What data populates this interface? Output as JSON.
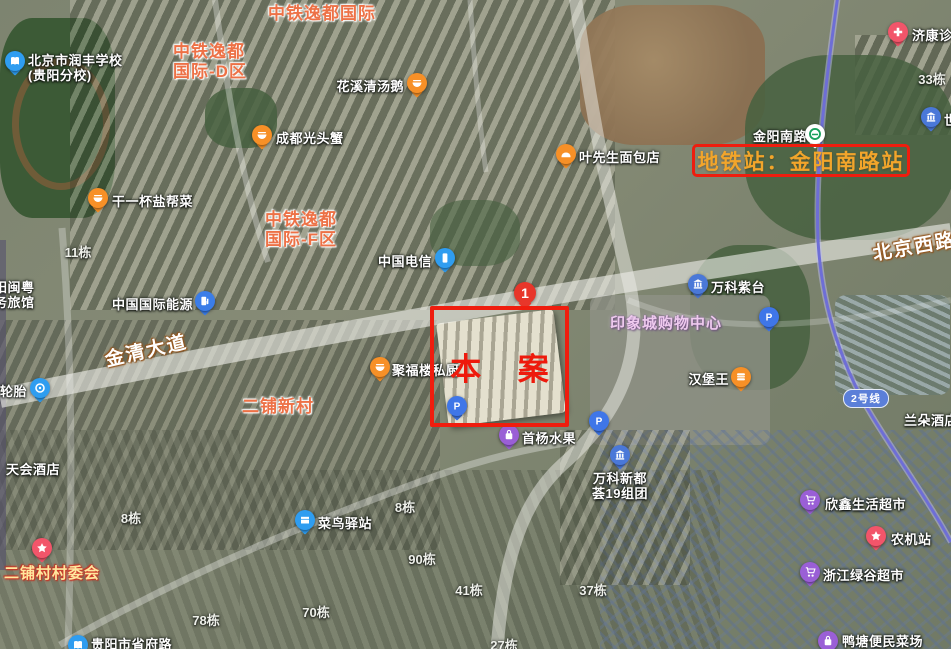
{
  "annotations": {
    "site_label": "本 案",
    "site_marker_number": "1",
    "metro_station_label": "地铁站：金阳南路站"
  },
  "metro": {
    "line_badge": "2号线",
    "badge_x": 843,
    "badge_y": 389
  },
  "road_labels": [
    {
      "name": "jinqing-avenue",
      "label": "金清大道",
      "x": 104,
      "y": 336,
      "rotate": -13
    },
    {
      "name": "beijing-west-road",
      "label": "北京西路",
      "x": 872,
      "y": 232,
      "rotate": -10
    }
  ],
  "area_labels": [
    {
      "name": "zhongtie-yidu-intl",
      "style": "estate",
      "lines": [
        "中铁逸都国际"
      ],
      "x": 268,
      "y": 4
    },
    {
      "name": "zhongtie-yidu-d",
      "style": "estate",
      "lines": [
        "中铁逸都",
        "国际-D区"
      ],
      "x": 173,
      "y": 42
    },
    {
      "name": "zhongtie-yidu-f",
      "style": "estate",
      "lines": [
        "中铁逸都",
        "国际-F区"
      ],
      "x": 265,
      "y": 210
    },
    {
      "name": "erpu-xincun",
      "style": "estate",
      "lines": [
        "二铺新村"
      ],
      "x": 242,
      "y": 397
    },
    {
      "name": "yinxiang-mall",
      "style": "mall",
      "lines": [
        "印象城购物中心"
      ],
      "x": 610,
      "y": 315
    }
  ],
  "building_numbers": [
    {
      "label": "11栋",
      "x": 78,
      "y": 242
    },
    {
      "label": "33栋",
      "x": 932,
      "y": 69
    },
    {
      "label": "8栋",
      "x": 131,
      "y": 508
    },
    {
      "label": "8栋",
      "x": 405,
      "y": 497
    },
    {
      "label": "90栋",
      "x": 422,
      "y": 549
    },
    {
      "label": "70栋",
      "x": 316,
      "y": 602
    },
    {
      "label": "78栋",
      "x": 206,
      "y": 610
    },
    {
      "label": "41栋",
      "x": 469,
      "y": 580
    },
    {
      "label": "37栋",
      "x": 593,
      "y": 580
    },
    {
      "label": "27栋",
      "x": 504,
      "y": 635
    }
  ],
  "text_labels": [
    {
      "name": "tianhui-hotel",
      "lines": [
        "天会酒店"
      ],
      "x": 6,
      "y": 462
    },
    {
      "name": "landuo-hotel",
      "lines": [
        "兰朵酒店"
      ],
      "x": 904,
      "y": 413
    },
    {
      "name": "yangminyue-inn",
      "lines": [
        "阳闽粤",
        "务旅馆"
      ],
      "x": -6,
      "y": 280
    },
    {
      "name": "jinyang-south-road",
      "lines": [
        "金阳南路"
      ],
      "x": 753,
      "y": 129
    }
  ],
  "pois": [
    {
      "name": "runfeng-school",
      "icon": "school-icon",
      "color": "#2f9df0",
      "x": 15,
      "y": 64,
      "lines": [
        "北京市润丰学校",
        "(贵阳分校)"
      ],
      "align": "left",
      "lx": 28,
      "ly": 53
    },
    {
      "name": "chengdu-crab",
      "icon": "restaurant-icon",
      "color": "#f79027",
      "x": 262,
      "y": 138,
      "lines": [
        "成都光头蟹"
      ],
      "align": "left",
      "lx": 276,
      "ly": 131
    },
    {
      "name": "salt-cuisine",
      "icon": "restaurant-icon",
      "color": "#f79027",
      "x": 98,
      "y": 201,
      "lines": [
        "干一杯盐帮菜"
      ],
      "align": "left",
      "lx": 112,
      "ly": 194
    },
    {
      "name": "goose-soup",
      "icon": "restaurant-icon",
      "color": "#f79027",
      "x": 417,
      "y": 86,
      "lines": [
        "花溪清汤鹅"
      ],
      "align": "right",
      "lx": 404,
      "ly": 79
    },
    {
      "name": "ye-bakery",
      "icon": "bread-icon",
      "color": "#f79027",
      "x": 566,
      "y": 157,
      "lines": [
        "叶先生面包店"
      ],
      "align": "left",
      "lx": 579,
      "ly": 150
    },
    {
      "name": "china-telecom",
      "icon": "phone-icon",
      "color": "#2f9df0",
      "x": 445,
      "y": 261,
      "lines": [
        "中国电信"
      ],
      "align": "right",
      "lx": 432,
      "ly": 254
    },
    {
      "name": "china-intl-energy",
      "icon": "fuel-icon",
      "color": "#3b7de8",
      "x": 205,
      "y": 304,
      "lines": [
        "中国国际能源"
      ],
      "align": "right",
      "lx": 193,
      "ly": 297
    },
    {
      "name": "jufulou-kitchen",
      "icon": "restaurant-icon",
      "color": "#f79027",
      "x": 380,
      "y": 370,
      "lines": [
        "聚福楼私厨"
      ],
      "align": "left",
      "lx": 392,
      "ly": 363
    },
    {
      "name": "burger-king",
      "icon": "burger-icon",
      "color": "#f79027",
      "x": 741,
      "y": 380,
      "lines": [
        "汉堡王"
      ],
      "align": "right",
      "lx": 729,
      "ly": 372
    },
    {
      "name": "vanke-zitai",
      "icon": "building-icon",
      "color": "#4a78d8",
      "x": 698,
      "y": 287,
      "lines": [
        "万科紫台"
      ],
      "align": "left",
      "lx": 711,
      "ly": 280
    },
    {
      "name": "vanke-xinduhui",
      "icon": "building-icon",
      "color": "#4a78d8",
      "x": 620,
      "y": 458,
      "lines": [
        "万科新都",
        "荟19组团"
      ],
      "align": "center",
      "lx": 620,
      "ly": 471
    },
    {
      "name": "cainiao-station",
      "icon": "package-icon",
      "color": "#2f9df0",
      "x": 305,
      "y": 523,
      "lines": [
        "菜鸟驿站"
      ],
      "align": "left",
      "lx": 318,
      "ly": 516
    },
    {
      "name": "shouyang-fruit",
      "icon": "bag-icon",
      "color": "#9a5fd6",
      "x": 509,
      "y": 438,
      "lines": [
        "首杨水果"
      ],
      "align": "left",
      "lx": 522,
      "ly": 431
    },
    {
      "name": "xinxin-supermarket",
      "icon": "cart-icon",
      "color": "#9a5fd6",
      "x": 810,
      "y": 503,
      "lines": [
        "欣鑫生活超市"
      ],
      "align": "left",
      "lx": 825,
      "ly": 497
    },
    {
      "name": "zhejiang-lvgu-supermarket",
      "icon": "cart-icon",
      "color": "#9a5fd6",
      "x": 810,
      "y": 575,
      "lines": [
        "浙江绿谷超市"
      ],
      "align": "left",
      "lx": 823,
      "ly": 568
    },
    {
      "name": "yatang-market",
      "icon": "bag-icon",
      "color": "#9a5fd6",
      "x": 828,
      "y": 644,
      "lines": [
        "鸭塘便民菜场"
      ],
      "align": "left",
      "lx": 842,
      "ly": 634
    },
    {
      "name": "nongji-station",
      "icon": "star-icon",
      "color": "#f2556a",
      "x": 876,
      "y": 539,
      "lines": [
        "农机站"
      ],
      "align": "left",
      "lx": 891,
      "ly": 532
    },
    {
      "name": "erpu-village-committee",
      "icon": "star-icon",
      "color": "#f2556a",
      "x": 42,
      "y": 551,
      "lines": [
        "二铺村村委会"
      ],
      "align": "left",
      "lx": 4,
      "ly": 565,
      "cls": "committee"
    },
    {
      "name": "jikang-clinic",
      "icon": "cross-icon",
      "color": "#f2556a",
      "x": 898,
      "y": 35,
      "lines": [
        "济康诊所"
      ],
      "align": "left",
      "lx": 912,
      "ly": 28
    },
    {
      "name": "shi-partial",
      "icon": "building-icon",
      "color": "#4a78d8",
      "x": 931,
      "y": 120,
      "lines": [
        "世"
      ],
      "align": "left",
      "lx": 944,
      "ly": 113
    },
    {
      "name": "tire-shop",
      "icon": "tire-icon",
      "color": "#2f9df0",
      "x": 40,
      "y": 391,
      "lines": [
        "捷轮胎"
      ],
      "align": "right",
      "lx": 27,
      "ly": 384
    },
    {
      "name": "metro-station",
      "icon": "metro-icon",
      "color": "#ffffff",
      "x": 815,
      "y": 137,
      "lines": [],
      "align": "left",
      "lx": 0,
      "ly": 0
    },
    {
      "name": "shengfulu-school",
      "icon": "school-icon",
      "color": "#2f9df0",
      "x": 78,
      "y": 648,
      "lines": [
        "贵阳市省府路"
      ],
      "align": "left",
      "lx": 91,
      "ly": 637
    },
    {
      "name": "parking-1",
      "icon": "parking-icon",
      "color": "#3f76e8",
      "x": 457,
      "y": 409,
      "lines": [],
      "align": "left",
      "lx": 0,
      "ly": 0
    },
    {
      "name": "parking-2",
      "icon": "parking-icon",
      "color": "#3f76e8",
      "x": 599,
      "y": 424,
      "lines": [],
      "align": "left",
      "lx": 0,
      "ly": 0
    },
    {
      "name": "parking-3",
      "icon": "parking-icon",
      "color": "#3f76e8",
      "x": 769,
      "y": 320,
      "lines": [],
      "align": "left",
      "lx": 0,
      "ly": 0
    }
  ],
  "colors": {
    "annotation_red": "#ef1d0e",
    "metro_label_orange": "#f2a52b",
    "estate_orange": "#ed7146",
    "mall_pink": "#eecaee",
    "metro_line": "#6e6ed6"
  }
}
